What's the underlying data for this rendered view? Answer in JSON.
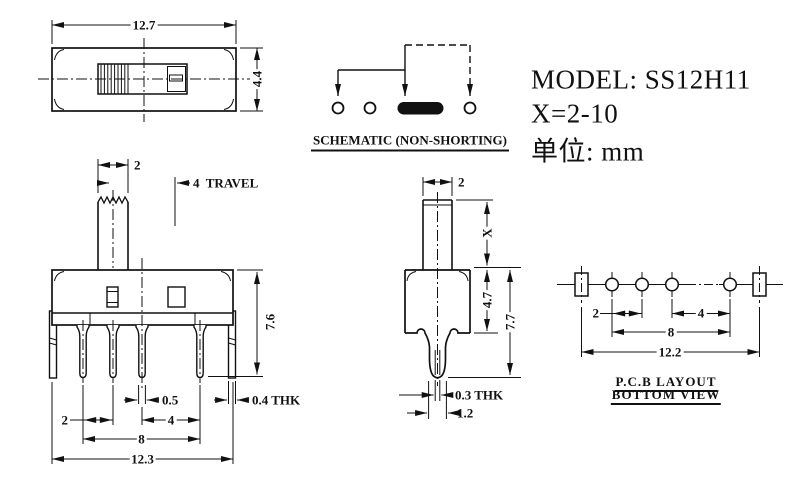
{
  "title_block": {
    "model": "MODEL: SS12H11",
    "x_range": "X=2-10",
    "unit": "单位: mm"
  },
  "schematic": {
    "title": "SCHEMATIC (NON-SHORTING)"
  },
  "top_view": {
    "width": "12.7",
    "height": "4.4"
  },
  "front_view": {
    "knob_width": "2",
    "travel": "4  TRAVEL",
    "body_height": "7.6",
    "pin_width": "0.5",
    "bracket_thickness": "0.4 THK",
    "pin_pitch_small": "2",
    "pin_pitch_large": "4",
    "pin_span": "8",
    "overall_width": "12.3"
  },
  "side_view": {
    "stem_width": "2",
    "stem_height": "X",
    "body_height": "4.7",
    "overall_height": "7.7",
    "pin_thickness": "0.3 THK",
    "pin_width": "1.2"
  },
  "pcb_layout": {
    "title_line1": "P.C.B LAYOUT",
    "title_line2": "BOTTOM VIEW",
    "hole_pitch_small": "2",
    "hole_pitch_large": "4",
    "hole_span": "8",
    "overall_span": "12.2"
  }
}
